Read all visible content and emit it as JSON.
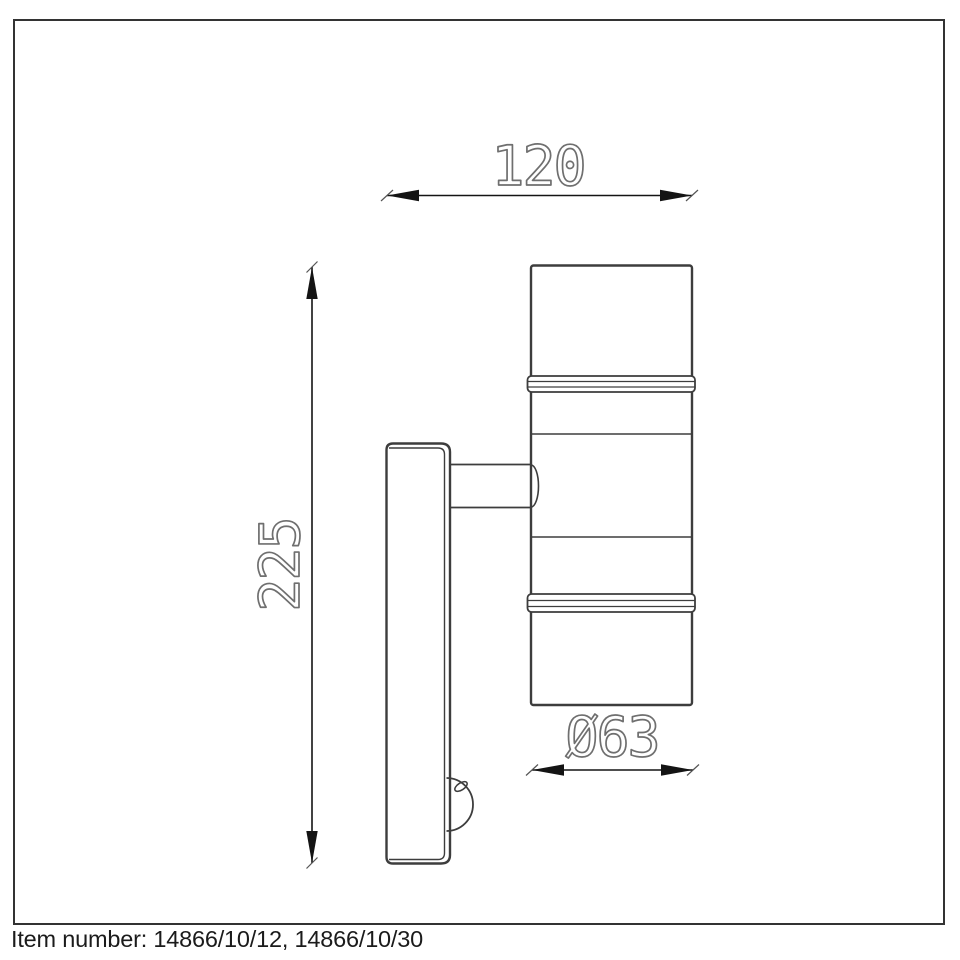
{
  "frame": {
    "border_color": "#333333"
  },
  "dimensions": {
    "width": {
      "label": "120"
    },
    "height": {
      "label": "225"
    },
    "diameter": {
      "label": "Ø63"
    }
  },
  "footer": {
    "item_number": "Item number: 14866/10/12, 14866/10/30"
  },
  "colors": {
    "background": "#ffffff",
    "drawing_line": "#3d3d3d",
    "dimension_line": "#141414",
    "dimension_text": "#6f6f6f",
    "footer_text": "#1b1b1b"
  }
}
